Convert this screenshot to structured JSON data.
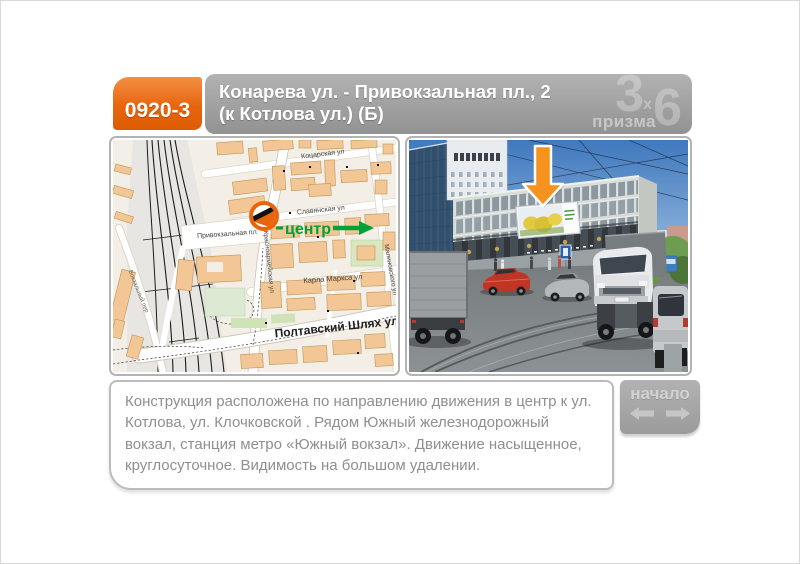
{
  "header": {
    "board_id": "0920-3",
    "title_line1": "Конарева ул. - Привокзальная пл., 2",
    "title_line2": "(к Котлова ул.)  (Б)",
    "logo_digit_left": "3",
    "logo_x": "х",
    "logo_digit_right": "6",
    "logo_name": "призма",
    "id_box_color": "#e8650e",
    "bar_color": "#9c9c9c"
  },
  "map": {
    "streets": {
      "kotsarska": "Коцарская ул",
      "slavyanska": "Славянская ул",
      "pryvokzalna": "Привокзальная пл",
      "krasnoarmiyska": "Красноармейская ул",
      "karla_marksa": "Карла Маркса ул",
      "poltavsky": "Полтавский Шлях ул",
      "malinovskogo": "Малиновского ул",
      "vokzalny": "Вокзальный пер"
    },
    "direction_label": "центр",
    "direction_color": "#00a13b",
    "marker_color": "#e8650e"
  },
  "photo": {
    "arrow_color": "#f6921e"
  },
  "description": {
    "text": "Конструкция расположена по направлению движения в центр к ул. Котлова, ул. Клочковской . Рядом  Южный железнодорожный вокзал, станция метро «Южный вокзал».  Движение насыщенное, круглосуточное. Видимость на большом удалении."
  },
  "nav": {
    "label": "начало"
  }
}
